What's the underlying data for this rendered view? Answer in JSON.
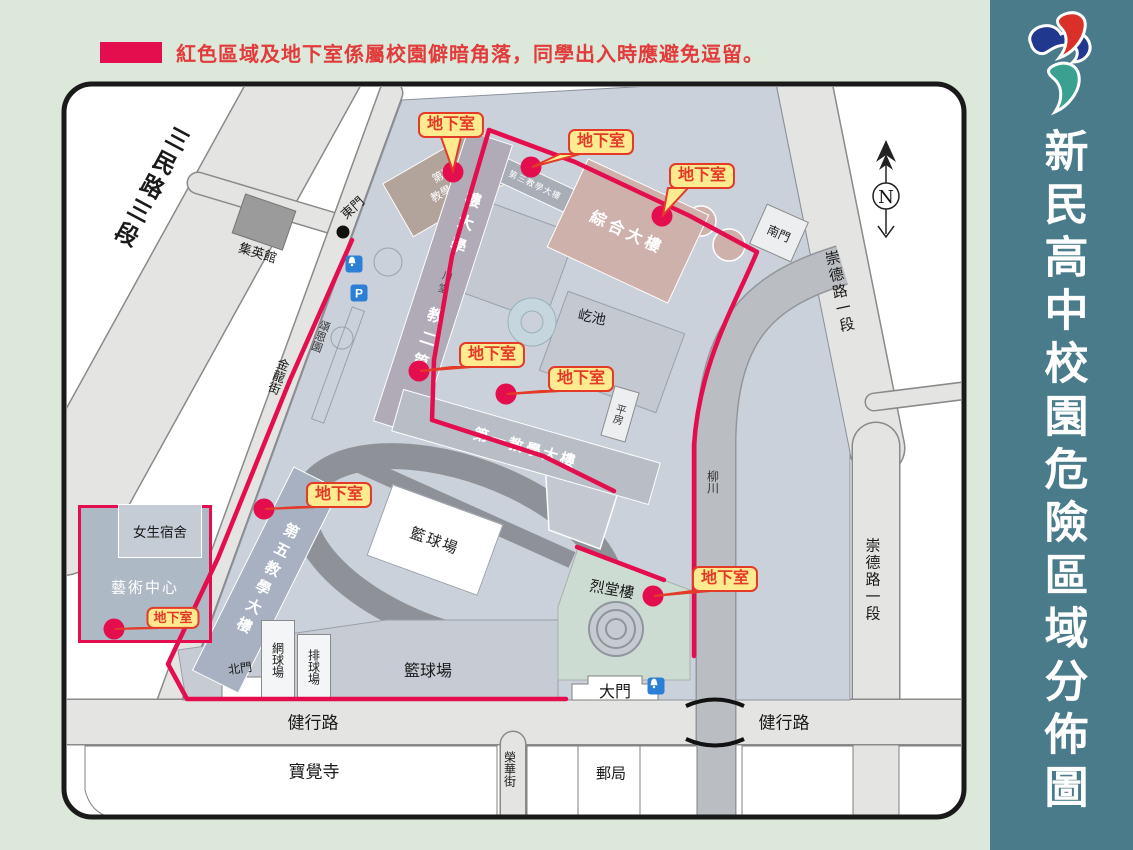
{
  "colors": {
    "danger_red": "#e40e4f",
    "basement_label_red": "#e43b28",
    "basement_label_bg": "#ffeb8f",
    "sidebar_teal": "#4a7b8a",
    "campus_bg": "#cbd1da",
    "legend_text_red": "#e13b3b"
  },
  "legend": {
    "text": "紅色區域及地下室係屬校園僻暗角落，同學出入時應避免逗留。"
  },
  "sidebar": {
    "title": "新民高中校園危險區域分佈圖"
  },
  "compass": {
    "label": "N"
  },
  "basement": {
    "label": "地下室"
  },
  "roads": {
    "sanmin": "三民路三段",
    "jinlong": "金龍街",
    "chongde_upper": "崇德路一段",
    "chongde_lower": "崇德路一段",
    "jianxing_west": "健行路",
    "jianxing_east": "健行路",
    "ronghua": "榮華街"
  },
  "river": {
    "name": "柳川"
  },
  "gates": {
    "east": "東門",
    "south": "南門",
    "north": "北門",
    "main": "大門"
  },
  "buildings": {
    "b4_line1": "第四",
    "b4_line2": "教學大樓",
    "b3": "第三教學大樓",
    "zonghe": "綜合大樓",
    "b2_upper": "樓大學",
    "b2_hall": "川堂",
    "b2_lower": "教二第",
    "b1": "第一教學大樓",
    "b5": "第五教學大樓",
    "pingfang": "平房",
    "dorm": "女生宿舍",
    "art_center": "藝術中心",
    "lietang": "烈堂樓",
    "jiying": "集英館",
    "songen": "頌恩園",
    "yichi": "屹池",
    "basketball_track": "籃球場",
    "basketball_south": "籃球場",
    "tennis": "網球場",
    "volleyball": "排球場",
    "baojue": "寶覺寺",
    "post_office": "郵局"
  },
  "icons": {
    "parking": "P"
  }
}
